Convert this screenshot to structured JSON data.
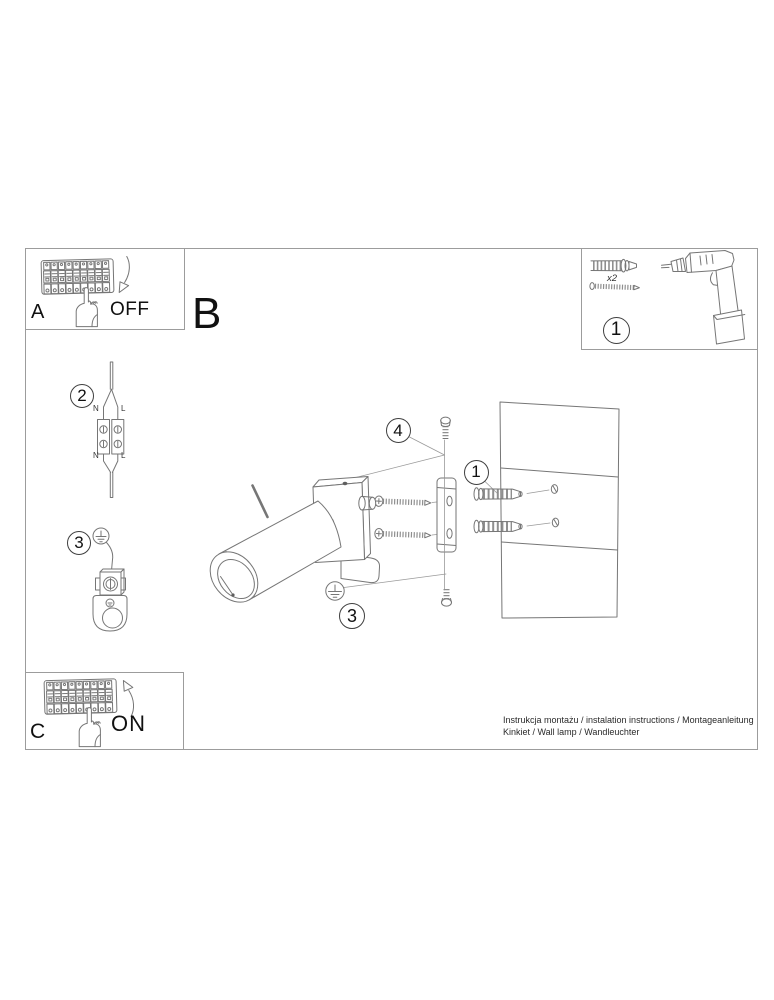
{
  "panel_a": {
    "label": "A",
    "state": "OFF"
  },
  "section_b": {
    "label": "B"
  },
  "panel_c": {
    "label": "C",
    "state": "ON"
  },
  "parts_box": {
    "callout": "1",
    "anchor_quantity": "x2"
  },
  "step2": {
    "callout": "2",
    "wire_labels": {
      "top_left": "N",
      "top_right": "L",
      "bottom_left": "N",
      "bottom_right": "L"
    }
  },
  "step3": {
    "callout": "3"
  },
  "assembly": {
    "callout_top_screw": "4",
    "callout_anchors": "1",
    "callout_ground_screw": "3"
  },
  "footer": {
    "line1": "Instrukcja montażu / instalation instructions / Montageanleitung",
    "line2": "Kinkiet / Wall lamp / Wandleuchter"
  }
}
